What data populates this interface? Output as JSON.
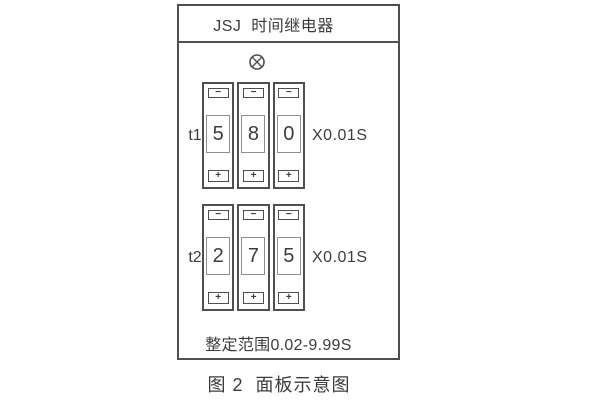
{
  "panel": {
    "title": "JSJ  时间继电器",
    "lamp_icon": "indicator-lamp-icon",
    "groups": [
      {
        "id": "t1",
        "label": "t1",
        "digits": [
          "5",
          "8",
          "0"
        ],
        "multiplier": "X0.01S"
      },
      {
        "id": "t2",
        "label": "t2",
        "digits": [
          "2",
          "7",
          "5"
        ],
        "multiplier": "X0.01S"
      }
    ],
    "range_text": "整定范围0.02-9.99S"
  },
  "controls": {
    "minus": "−",
    "plus": "+"
  },
  "caption": "图 2  面板示意图",
  "colors": {
    "line": "#4f4f4f",
    "window_border": "#8f8f8f",
    "text": "#3c3c3c",
    "background": "#ffffff"
  }
}
